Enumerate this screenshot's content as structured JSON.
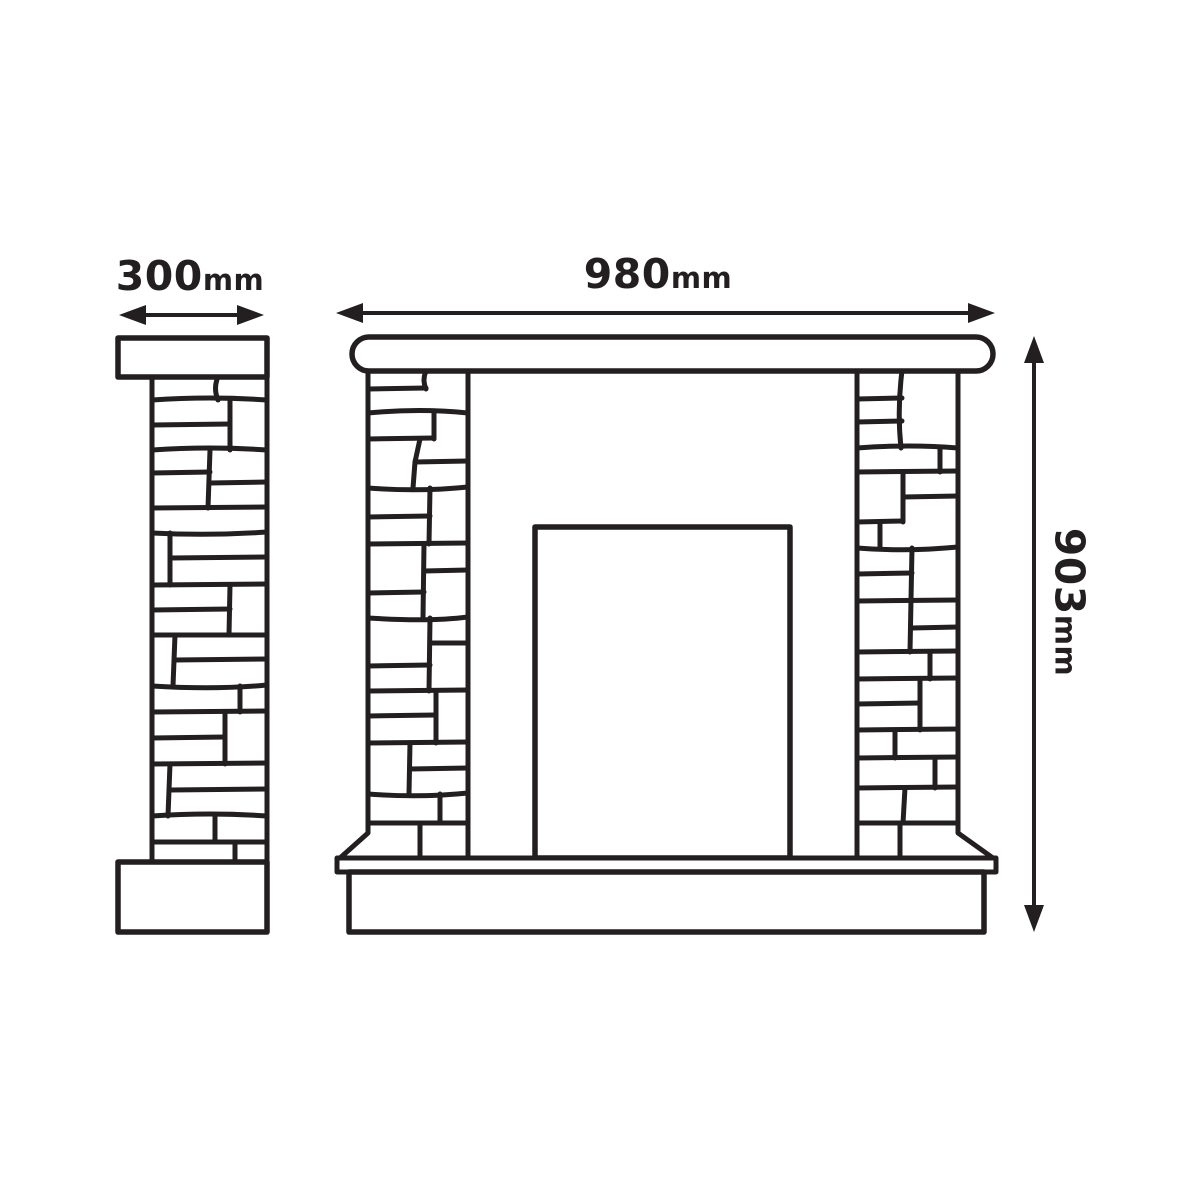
{
  "colors": {
    "background": "#ffffff",
    "line": "#231f20"
  },
  "dimensions": {
    "side_width": {
      "value": "300",
      "unit": "mm"
    },
    "front_width": {
      "value": "980",
      "unit": "mm"
    },
    "front_height": {
      "value": "903",
      "unit": "mm"
    }
  },
  "icons": {
    "side_width_arrow": "double-headed-horizontal-arrow",
    "front_width_arrow": "double-headed-horizontal-arrow",
    "front_height_arrow": "double-headed-vertical-arrow"
  },
  "diagram": {
    "type": "technical line drawing",
    "views": [
      "side profile",
      "front elevation"
    ]
  }
}
